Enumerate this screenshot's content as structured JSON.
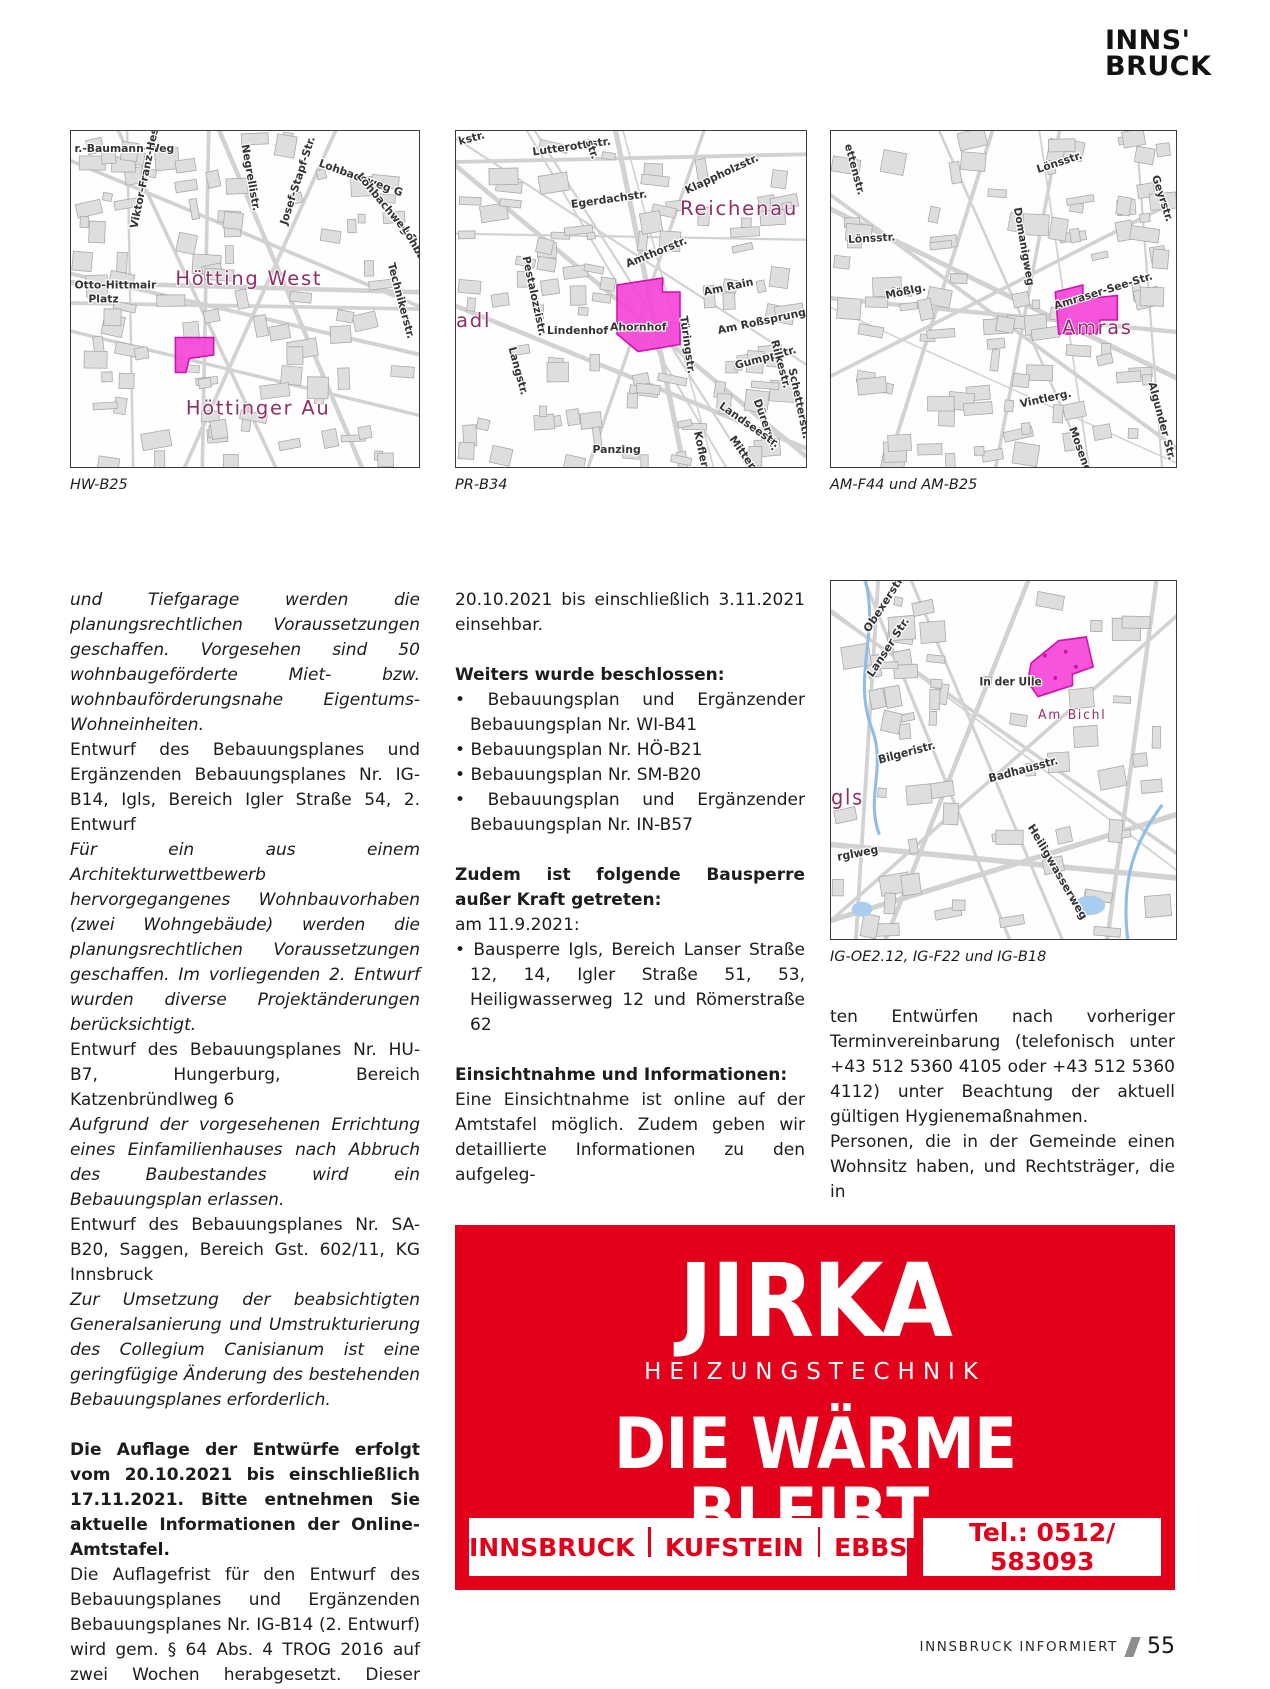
{
  "logo": {
    "line1": "INNS'",
    "line2": "BRUCK"
  },
  "colors": {
    "ad_red": "#e2001a",
    "parcel": "#f541d6",
    "parcel_border": "#cf12ae",
    "map_area": "#8f2e68"
  },
  "maps": [
    {
      "caption": "HW-B25",
      "areas": [
        {
          "t": "Hötting West",
          "x": 30,
          "y": 44
        },
        {
          "t": "Höttinger Au",
          "x": 33,
          "y": 81
        }
      ],
      "streets": [
        {
          "t": "r.-Baumann-Weg",
          "x": 1,
          "y": 6,
          "r": 0
        },
        {
          "t": "Viktor-Franz-Hess-Str.",
          "x": 19,
          "y": 28,
          "r": -78
        },
        {
          "t": "Negrellistr.",
          "x": 49,
          "y": 4,
          "r": 80
        },
        {
          "t": "Josef-Stapf-Str.",
          "x": 62,
          "y": 27,
          "r": -72
        },
        {
          "t": "Lohbachweg G",
          "x": 71,
          "y": 10,
          "r": 20
        },
        {
          "t": "Lohbachweg F",
          "x": 82,
          "y": 13,
          "r": 50
        },
        {
          "t": "Lohbachw.",
          "x": 95,
          "y": 28,
          "r": 60
        },
        {
          "t": "Technikerstr.",
          "x": 91,
          "y": 38,
          "r": 75
        },
        {
          "t": "Otto-Hittmair",
          "x": 1,
          "y": 45,
          "r": 0
        },
        {
          "t": "Platz",
          "x": 5,
          "y": 49,
          "r": 0
        }
      ],
      "parcel": "30,59 41,59 41,64 34,65 33,69 30,69",
      "dots": []
    },
    {
      "caption": "PR-B34",
      "areas": [
        {
          "t": "Reichenau",
          "x": 64,
          "y": 24
        },
        {
          "t": "adl",
          "x": 0,
          "y": 56
        }
      ],
      "streets": [
        {
          "t": "kstr.",
          "x": 1,
          "y": 4,
          "r": -15
        },
        {
          "t": "Lutterottistr.",
          "x": 22,
          "y": 7,
          "r": -8
        },
        {
          "t": "str.",
          "x": 37,
          "y": 3,
          "r": 70
        },
        {
          "t": "Egerdachstr.",
          "x": 33,
          "y": 22,
          "r": -8
        },
        {
          "t": "Klappholzstr.",
          "x": 66,
          "y": 18,
          "r": -25
        },
        {
          "t": "Pestalozzistr.",
          "x": 19,
          "y": 36,
          "r": 78
        },
        {
          "t": "Amthorstr.",
          "x": 49,
          "y": 39,
          "r": -22
        },
        {
          "t": "Am Rain",
          "x": 71,
          "y": 47,
          "r": -12
        },
        {
          "t": "Türingstr.",
          "x": 64,
          "y": 53,
          "r": 82
        },
        {
          "t": "Am Roßsprung",
          "x": 75,
          "y": 58,
          "r": -12
        },
        {
          "t": "Lindenhof",
          "x": 26,
          "y": 58,
          "r": 0
        },
        {
          "t": "Ahornhof",
          "x": 44,
          "y": 57,
          "r": 0
        },
        {
          "t": "Langstr.",
          "x": 15,
          "y": 62,
          "r": 75
        },
        {
          "t": "Gumppstr.",
          "x": 80,
          "y": 68,
          "r": -15
        },
        {
          "t": "Schetterstr.",
          "x": 95,
          "y": 68,
          "r": 78
        },
        {
          "t": "Rilkestr.",
          "x": 90,
          "y": 60,
          "r": 75
        },
        {
          "t": "Dürerstr.",
          "x": 85,
          "y": 77,
          "r": 70
        },
        {
          "t": "Landseestr.",
          "x": 75,
          "y": 79,
          "r": 35
        },
        {
          "t": "Koflerstr.",
          "x": 68,
          "y": 86,
          "r": 78
        },
        {
          "t": "Mitterstr.",
          "x": 78,
          "y": 88,
          "r": 55
        },
        {
          "t": "Panzing",
          "x": 39,
          "y": 92,
          "r": 0
        }
      ],
      "parcel": "46,44 59,42 59,46 64,46 64,61 52,63 46,58",
      "dots": []
    },
    {
      "caption": "AM-F44 und AM-B25",
      "areas": [
        {
          "t": "Amras",
          "x": 67,
          "y": 58
        }
      ],
      "streets": [
        {
          "t": "ettenstr.",
          "x": 4,
          "y": 4,
          "r": 75
        },
        {
          "t": "Lönsstr.",
          "x": 60,
          "y": 12,
          "r": -18
        },
        {
          "t": "Geyrstr.",
          "x": 93,
          "y": 13,
          "r": 72
        },
        {
          "t": "Lönsstr.",
          "x": 5,
          "y": 32,
          "r": -3
        },
        {
          "t": "Domanigweg",
          "x": 53,
          "y": 22,
          "r": 80
        },
        {
          "t": "Mößlg.",
          "x": 16,
          "y": 48,
          "r": -12
        },
        {
          "t": "Amraser-See-Str.",
          "x": 65,
          "y": 51,
          "r": -17
        },
        {
          "t": "Vintlerg.",
          "x": 55,
          "y": 79,
          "r": -12
        },
        {
          "t": "Moseng.",
          "x": 69,
          "y": 85,
          "r": 70
        },
        {
          "t": "Algunder Str.",
          "x": 92,
          "y": 72,
          "r": 75
        }
      ],
      "parcel": "65,46 73,44 73,48 83,47 83,54 78,54 77,58 66,58",
      "dots": []
    },
    {
      "caption": "IG-OE2.12, IG-F22 und IG-B18",
      "water": true,
      "dense": false,
      "areas": [
        {
          "t": "gls",
          "x": 0,
          "y": 60
        },
        {
          "t": "Am Bichl",
          "x": 60,
          "y": 37,
          "small": true
        }
      ],
      "streets": [
        {
          "t": "Obexerstr.",
          "x": 11,
          "y": 14,
          "r": -55
        },
        {
          "t": "Lanser Str.",
          "x": 12,
          "y": 26,
          "r": -55
        },
        {
          "t": "In der Ulle",
          "x": 43,
          "y": 28,
          "r": 0
        },
        {
          "t": "Bilgeristr.",
          "x": 14,
          "y": 49,
          "r": -14
        },
        {
          "t": "Badhausstr.",
          "x": 46,
          "y": 54,
          "r": -14
        },
        {
          "t": "Heiligwasserweg",
          "x": 57,
          "y": 66,
          "r": 58
        },
        {
          "t": "rglweg",
          "x": 2,
          "y": 75,
          "r": -10
        }
      ],
      "parcel": "58,22 66,16 74,15 76,23 70,25 70,28 60,31 57,27",
      "dots": [
        [
          62,
          20
        ],
        [
          68,
          19
        ],
        [
          71,
          23
        ],
        [
          65,
          26
        ]
      ]
    }
  ],
  "columns": {
    "left": [
      {
        "style": "italic",
        "text": "und Tiefgarage werden die planungsrechtlichen Voraussetzungen geschaffen. Vorgesehen sind 50 wohnbaugeförderte Miet- bzw. wohnbauförderungsnahe Eigentums-Wohneinheiten."
      },
      {
        "text": "Entwurf des Bebauungsplanes und Ergänzenden Bebauungsplanes Nr. IG-B14, Igls, Bereich Igler Straße 54, 2. Entwurf"
      },
      {
        "style": "italic",
        "text": "Für ein aus einem Architekturwettbewerb hervorgegangenes Wohnbauvorhaben (zwei Wohngebäude) werden die planungsrechtlichen Voraussetzungen geschaffen. Im vorliegenden 2. Entwurf wurden diverse Projektänderungen berücksichtigt."
      },
      {
        "text": "Entwurf des Bebauungsplanes Nr. HU-B7, Hungerburg, Bereich Katzenbründlweg 6"
      },
      {
        "style": "italic",
        "text": "Aufgrund der vorgesehenen Errichtung eines Einfamilienhauses nach Abbruch des Baubestandes wird ein Bebauungsplan erlassen."
      },
      {
        "text": "Entwurf des Bebauungsplanes Nr. SA-B20, Saggen, Bereich Gst. 602/11, KG Innsbruck"
      },
      {
        "style": "italic",
        "text": "Zur Umsetzung der beabsichtigten Generalsanierung und Umstrukturierung des Collegium Canisianum ist eine geringfügige Änderung des bestehenden Bebauungsplanes erforderlich."
      },
      {
        "style": "bold",
        "gap": true,
        "text": "Die Auflage der Entwürfe erfolgt vom 20.10.2021 bis einschließlich 17.11.2021. Bitte entnehmen Sie aktuelle Informationen der Online-Amtstafel."
      },
      {
        "text": "Die Auflagefrist für den Entwurf des Bebauungsplanes und Ergänzenden Bebauungsplanes Nr. IG-B14 (2. Entwurf) wird gem. § 64 Abs. 4 TROG 2016 auf zwei Wochen herabgesetzt. Dieser Entwurf ist vom"
      }
    ],
    "mid": [
      {
        "text": "20.10.2021 bis einschließlich 3.11.2021 einsehbar."
      },
      {
        "style": "bold",
        "gap": true,
        "text": "Weiters wurde beschlossen:"
      },
      {
        "bullet": true,
        "text": "Bebauungsplan und Ergänzender Bebauungsplan Nr. WI-B41"
      },
      {
        "bullet": true,
        "text": "Bebauungsplan Nr. HÖ-B21"
      },
      {
        "bullet": true,
        "text": "Bebauungsplan Nr. SM-B20"
      },
      {
        "bullet": true,
        "text": "Bebauungsplan und Ergänzender Bebauungsplan Nr. IN-B57"
      },
      {
        "style": "bold",
        "gap": true,
        "text": "Zudem ist folgende Bausperre außer Kraft getreten:"
      },
      {
        "text": "am 11.9.2021:"
      },
      {
        "bullet": true,
        "text": "Bausperre Igls, Bereich Lanser Straße 12, 14, Igler Straße 51, 53, Heiligwasserweg 12 und Römerstraße 62"
      },
      {
        "style": "bold",
        "gap": true,
        "text": "Einsichtnahme und Informationen:"
      },
      {
        "text": "Eine Einsichtnahme ist online auf der Amtstafel möglich. Zudem geben wir detaillierte Informationen zu den aufgeleg-"
      }
    ],
    "right": [
      {
        "text": "ten Entwürfen nach vorheriger Terminvereinbarung (telefonisch unter +43 512 5360 4105 oder +43 512 5360 4112) unter Beachtung der aktuell gültigen Hygienemaßnahmen."
      },
      {
        "text": "Personen, die in der Gemeinde einen Wohnsitz haben, und Rechtsträger, die in"
      }
    ]
  },
  "ad": {
    "brand": "JIRKA",
    "subtitle": "HEIZUNGSTECHNIK",
    "slogan": "DIE WÄRME BLEIBT.",
    "locations": [
      "INNSBRUCK",
      "KUFSTEIN",
      "EBBS"
    ],
    "phone": "Tel.: 0512/ 583093"
  },
  "footer": {
    "magazine": "INNSBRUCK INFORMIERT",
    "page": "55"
  }
}
